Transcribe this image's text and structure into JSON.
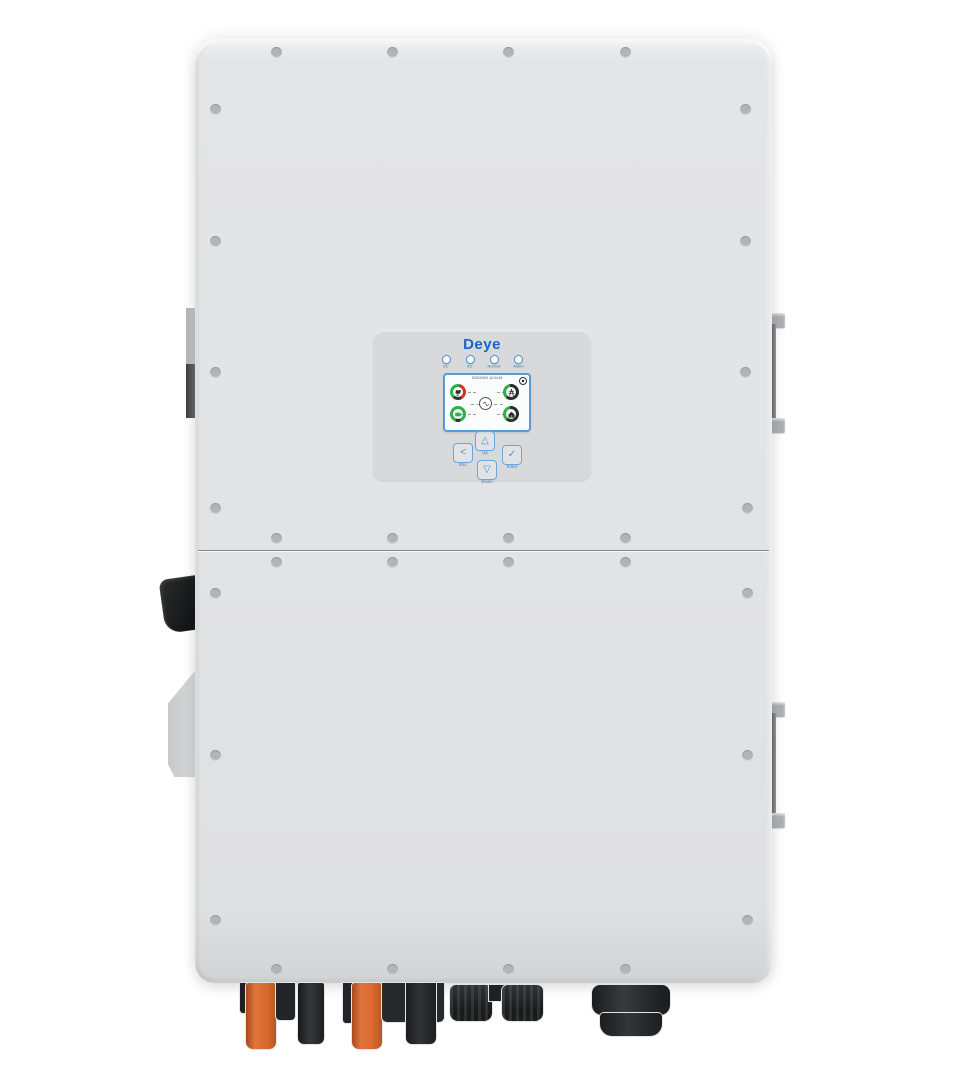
{
  "device": {
    "brand_logo": "Deye",
    "panel": {
      "leds": [
        {
          "label": "DC"
        },
        {
          "label": "AC"
        },
        {
          "label": "Normal"
        },
        {
          "label": "Alarm"
        }
      ],
      "screen": {
        "timestamp": "2020/09/01 10:34:45",
        "gauges": [
          {
            "id": "pv",
            "value": "0W"
          },
          {
            "id": "grid",
            "value": "0W"
          },
          {
            "id": "battery",
            "value": "0W"
          },
          {
            "id": "load",
            "value": "0W"
          }
        ]
      },
      "buttons": [
        {
          "id": "esc",
          "glyph": "<",
          "label": "Esc"
        },
        {
          "id": "up",
          "glyph": "△",
          "label": "Up"
        },
        {
          "id": "down",
          "glyph": "▽",
          "label": "Down"
        },
        {
          "id": "enter",
          "glyph": "✓",
          "label": "Enter"
        }
      ]
    },
    "colors": {
      "body_gray": "#e2e3e5",
      "panel_gray": "#d8dadc",
      "accent_blue": "#4f8fd6",
      "logo_blue": "#1566c8",
      "gauge_green": "#2fae49",
      "gauge_red": "#d93025",
      "connector_orange": "#d96a2e",
      "connector_black": "#1e1f21"
    }
  }
}
